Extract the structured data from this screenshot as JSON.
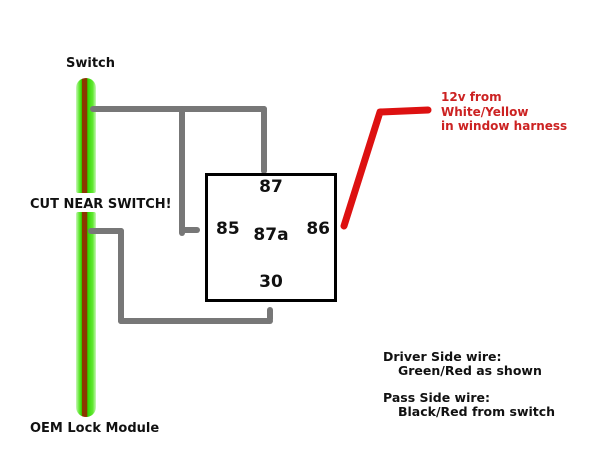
{
  "colors": {
    "wire_green": "#2fd800",
    "wire_green_glow": "#c9f6b9",
    "wire_stripe_red": "#8b3700",
    "wire_gray": "#777777",
    "wire_red": "#dd1111",
    "text_red": "#cc2222",
    "text_black": "#111111"
  },
  "labels": {
    "switch": "Switch",
    "cut_near_switch": "CUT NEAR SWITCH!",
    "oem_lock_module": "OEM Lock Module"
  },
  "relay": {
    "pins": {
      "top": "87",
      "left": "85",
      "center": "87a",
      "right": "86",
      "bottom": "30"
    }
  },
  "annotations": {
    "power": {
      "lines": [
        "12v from",
        "White/Yellow",
        "in window harness"
      ]
    },
    "notes": [
      {
        "title": "Driver Side wire:",
        "detail": "Green/Red as shown"
      },
      {
        "title": "Pass Side wire:",
        "detail": "Black/Red from switch"
      }
    ]
  }
}
